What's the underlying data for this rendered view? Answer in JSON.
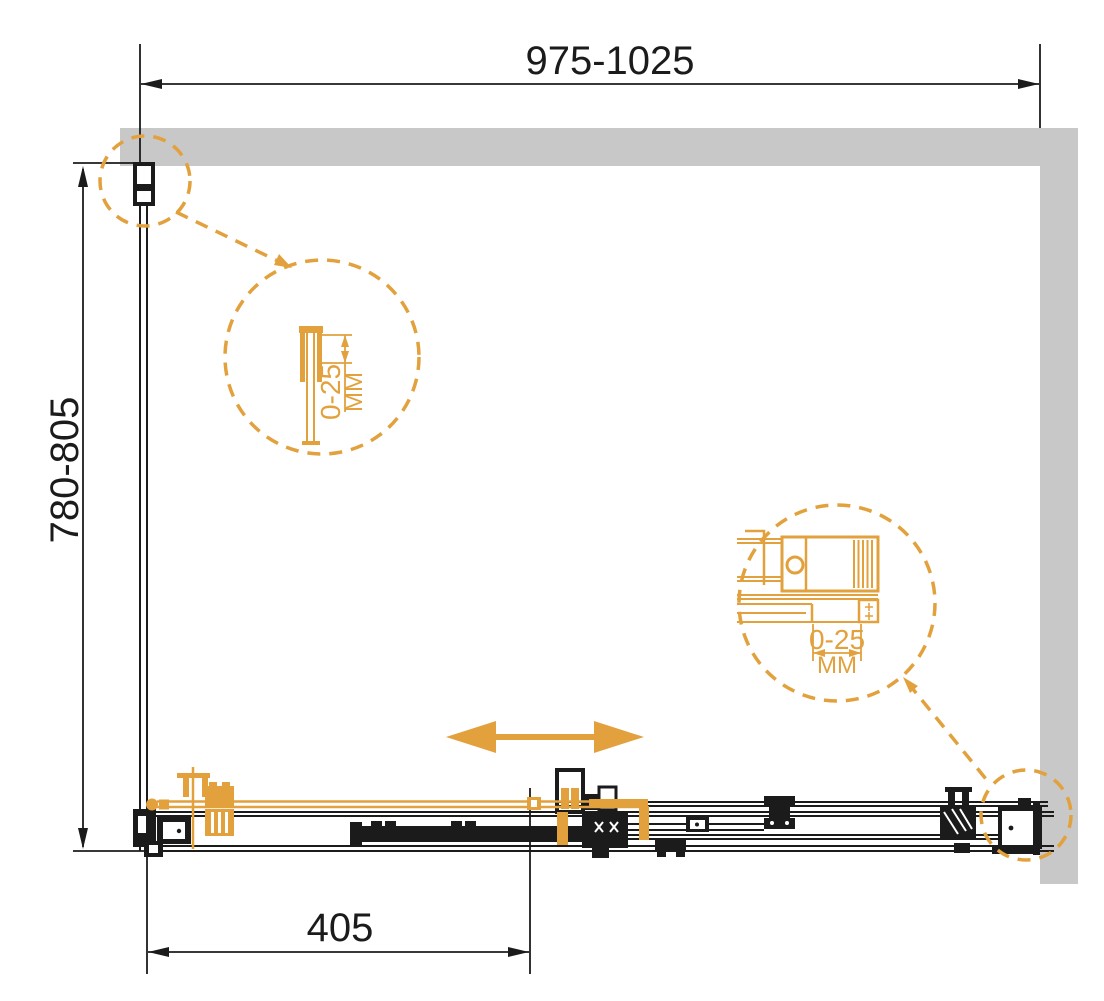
{
  "colors": {
    "accent_orange": "#E2A13C",
    "line_black": "#1B1B1B",
    "wall_gray": "#C8C8C8"
  },
  "dimensions": {
    "width_range": "975-1025",
    "depth_range": "780-805",
    "door_width": "405"
  },
  "detail_left": {
    "range": "0-25",
    "unit": "MM"
  },
  "detail_right": {
    "range": "0-25",
    "unit": "MM"
  }
}
